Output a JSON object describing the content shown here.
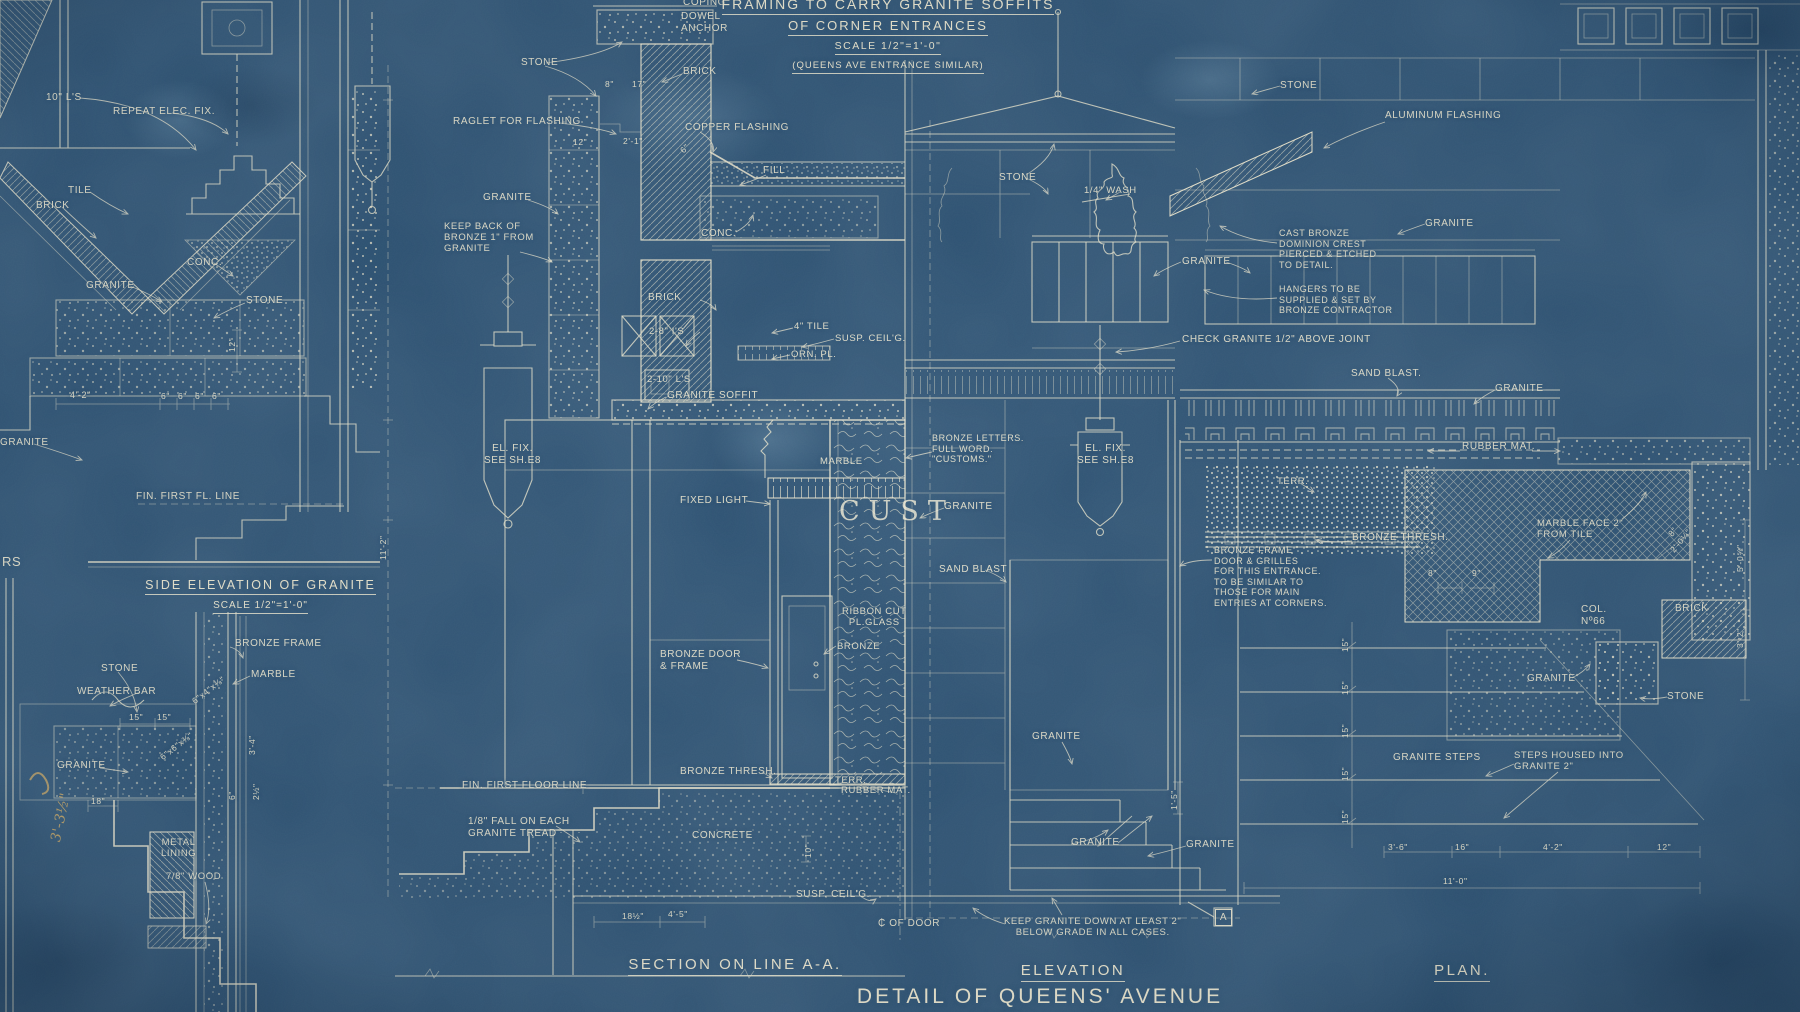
{
  "sheet": {
    "kind": "blueprint architectural drawing",
    "colors": {
      "background": "#2d5273",
      "ink": "#e9e3cb",
      "sepia_pencil": "#c6a35f"
    }
  },
  "titles": {
    "framing": {
      "line1": "FRAMING TO CARRY GRANITE SOFFITS",
      "line2": "OF CORNER ENTRANCES",
      "scale": "SCALE 1/2\"=1'-0\"",
      "note": "(QUEENS AVE ENTRANCE SIMILAR)"
    },
    "side_elevation": {
      "title": "SIDE ELEVATION OF GRANITE",
      "scale": "SCALE 1/2\"=1'-0\""
    },
    "section": {
      "title": "SECTION ON LINE A-A."
    },
    "elevation": {
      "title": "ELEVATION"
    },
    "plan": {
      "title": "PLAN."
    },
    "detail": {
      "title": "DETAIL OF QUEENS' AVENUE ENTRANCE"
    }
  },
  "labels": [
    {
      "t": "10\" L'S",
      "x": 46,
      "y": 92
    },
    {
      "t": "REPEAT ELEC. FIX.",
      "x": 113,
      "y": 106
    },
    {
      "t": "TILE",
      "x": 68,
      "y": 185
    },
    {
      "t": "BRICK",
      "x": 36,
      "y": 200
    },
    {
      "t": "CONC.",
      "x": 187,
      "y": 257
    },
    {
      "t": "GRANITE",
      "x": 86,
      "y": 280
    },
    {
      "t": "STONE",
      "x": 246,
      "y": 295
    },
    {
      "t": "GRANITE",
      "x": 0,
      "y": 437
    },
    {
      "t": "4'-2\"",
      "x": 70,
      "y": 390,
      "s": 9
    },
    {
      "t": "6\"",
      "x": 161,
      "y": 391,
      "s": 8.5
    },
    {
      "t": "6\"",
      "x": 178,
      "y": 391,
      "s": 8.5
    },
    {
      "t": "6\"",
      "x": 195,
      "y": 391,
      "s": 8.5
    },
    {
      "t": "6\"",
      "x": 212,
      "y": 391,
      "s": 8.5
    },
    {
      "t": "12\"",
      "x": 227,
      "y": 352,
      "r": -90,
      "s": 8.5
    },
    {
      "t": "FIN. FIRST FL. LINE",
      "x": 136,
      "y": 491
    },
    {
      "t": "RS",
      "x": 2,
      "y": 554,
      "s": 13
    },
    {
      "t": "BRONZE FRAME",
      "x": 235,
      "y": 638
    },
    {
      "t": "STONE",
      "x": 101,
      "y": 663
    },
    {
      "t": "MARBLE",
      "x": 251,
      "y": 669
    },
    {
      "t": "WEATHER BAR",
      "x": 77,
      "y": 686
    },
    {
      "t": "15\"",
      "x": 129,
      "y": 712,
      "s": 8.5
    },
    {
      "t": "15\"",
      "x": 157,
      "y": 712,
      "s": 8.5
    },
    {
      "t": "6\"x4\"x⅜\"",
      "x": 190,
      "y": 698,
      "r": -38,
      "s": 8.5
    },
    {
      "t": "GRANITE",
      "x": 57,
      "y": 760
    },
    {
      "t": "6\"x6\"x⅜\"",
      "x": 158,
      "y": 754,
      "r": -38,
      "s": 8.5
    },
    {
      "t": "3'-4\"",
      "x": 247,
      "y": 755,
      "r": -90,
      "s": 8.5
    },
    {
      "t": "18\"",
      "x": 91,
      "y": 796,
      "s": 8.5
    },
    {
      "t": "6\"",
      "x": 227,
      "y": 800,
      "r": -90,
      "s": 8.5
    },
    {
      "t": "2½\"",
      "x": 251,
      "y": 800,
      "r": -90,
      "s": 8.5
    },
    {
      "t": "METAL\nLINING",
      "x": 161,
      "y": 837,
      "ctr": 1,
      "s": 9.5
    },
    {
      "t": "7/8\" WOOD",
      "x": 166,
      "y": 871,
      "s": 9.5
    },
    {
      "t": "3'-3½\"",
      "x": 48,
      "y": 840,
      "r": -78,
      "c": "sepia",
      "s": 14
    },
    {
      "t": "COPING",
      "x": 683,
      "y": -3
    },
    {
      "t": "DOWEL\nANCHOR",
      "x": 681,
      "y": 11
    },
    {
      "t": "STONE",
      "x": 521,
      "y": 57
    },
    {
      "t": "BRICK",
      "x": 683,
      "y": 66
    },
    {
      "t": "8\"",
      "x": 605,
      "y": 79,
      "s": 8.5
    },
    {
      "t": "17\"",
      "x": 632,
      "y": 79,
      "s": 8.5
    },
    {
      "t": "RAGLET FOR FLASHING",
      "x": 453,
      "y": 116
    },
    {
      "t": "COPPER FLASHING",
      "x": 685,
      "y": 122
    },
    {
      "t": "12\"",
      "x": 573,
      "y": 137,
      "s": 8.5
    },
    {
      "t": "2'-1\"",
      "x": 623,
      "y": 136,
      "s": 8.5
    },
    {
      "t": "6\"",
      "x": 678,
      "y": 148,
      "r": -45,
      "s": 8.5
    },
    {
      "t": "FILL",
      "x": 763,
      "y": 165
    },
    {
      "t": "GRANITE",
      "x": 483,
      "y": 192
    },
    {
      "t": "KEEP BACK OF\nBRONZE 1\" FROM\nGRANITE",
      "x": 444,
      "y": 221,
      "s": 9.5
    },
    {
      "t": "CONC.",
      "x": 701,
      "y": 228
    },
    {
      "t": "BRICK",
      "x": 648,
      "y": 292
    },
    {
      "t": "2-8\" I'S",
      "x": 649,
      "y": 326,
      "s": 9.5
    },
    {
      "t": "4\" TILE",
      "x": 794,
      "y": 321,
      "s": 9.5
    },
    {
      "t": "SUSP. CEIL'G.",
      "x": 835,
      "y": 333,
      "s": 9.5
    },
    {
      "t": "ORN. PL.",
      "x": 791,
      "y": 349,
      "s": 9.5
    },
    {
      "t": "2-10\" L'S",
      "x": 647,
      "y": 374,
      "s": 9.5
    },
    {
      "t": "GRANITE SOFFIT",
      "x": 667,
      "y": 390
    },
    {
      "t": "EL. FIX.\nSEE SH.E8",
      "x": 484,
      "y": 443,
      "ctr": 1
    },
    {
      "t": "MARBLE",
      "x": 820,
      "y": 456,
      "s": 9.5
    },
    {
      "t": "FIXED LIGHT",
      "x": 680,
      "y": 495
    },
    {
      "t": "CUST",
      "x": 839,
      "y": 496,
      "c": "cust"
    },
    {
      "t": "RIBBON CUT\nPL.GLASS",
      "x": 842,
      "y": 606,
      "ctr": 1,
      "s": 9.5
    },
    {
      "t": "BRONZE",
      "x": 837,
      "y": 641,
      "s": 9.5
    },
    {
      "t": "BRONZE DOOR\n& FRAME",
      "x": 660,
      "y": 649
    },
    {
      "t": "11'-2\"",
      "x": 378,
      "y": 560,
      "r": -90,
      "s": 8.5
    },
    {
      "t": "FIN. FIRST FLOOR LINE",
      "x": 462,
      "y": 780
    },
    {
      "t": "BRONZE THRESH.",
      "x": 680,
      "y": 766
    },
    {
      "t": "TERR.",
      "x": 835,
      "y": 775,
      "s": 9.5
    },
    {
      "t": "RUBBER MAT.",
      "x": 841,
      "y": 785,
      "s": 9.5
    },
    {
      "t": "1/8\" FALL ON EACH\nGRANITE TREAD",
      "x": 468,
      "y": 816
    },
    {
      "t": "CONCRETE",
      "x": 692,
      "y": 830
    },
    {
      "t": "10\"",
      "x": 803,
      "y": 858,
      "r": -90,
      "s": 8.5
    },
    {
      "t": "SUSP. CEIL'G.",
      "x": 796,
      "y": 889
    },
    {
      "t": "18½\"",
      "x": 622,
      "y": 911,
      "s": 8.5
    },
    {
      "t": "4'-5\"",
      "x": 668,
      "y": 909,
      "s": 8.5
    },
    {
      "t": "₵ OF DOOR",
      "x": 878,
      "y": 918
    },
    {
      "t": "KEEP GRANITE DOWN AT LEAST 2\"\nBELOW GRADE IN ALL CASES.",
      "x": 1004,
      "y": 916,
      "ctr": 1,
      "s": 9.5
    },
    {
      "t": "STONE",
      "x": 999,
      "y": 172
    },
    {
      "t": "1/4\" WASH",
      "x": 1084,
      "y": 185,
      "s": 9.5
    },
    {
      "t": "GRANITE",
      "x": 1182,
      "y": 256
    },
    {
      "t": "CAST BRONZE\nDOMINION CREST\nPIERCED & ETCHED\nTO DETAIL.",
      "x": 1279,
      "y": 228,
      "s": 9
    },
    {
      "t": "HANGERS TO BE\nSUPPLIED & SET BY\nBRONZE CONTRACTOR",
      "x": 1279,
      "y": 284,
      "s": 9
    },
    {
      "t": "CHECK GRANITE 1/2\" ABOVE JOINT",
      "x": 1182,
      "y": 334
    },
    {
      "t": "SAND BLAST.",
      "x": 1351,
      "y": 368
    },
    {
      "t": "EL. FIX.\nSEE SH.E8",
      "x": 1077,
      "y": 443,
      "ctr": 1
    },
    {
      "t": "BRONZE LETTERS.\nFULL WORD.\n\"CUSTOMS.\"",
      "x": 932,
      "y": 433,
      "s": 9
    },
    {
      "t": "GRANITE",
      "x": 944,
      "y": 501
    },
    {
      "t": "SAND BLAST",
      "x": 939,
      "y": 564
    },
    {
      "t": "BRONZE FRAME\nDOOR & GRILLES\nFOR THIS ENTRANCE.\nTO BE SIMILAR TO\nTHOSE FOR MAIN\nENTRIES AT CORNERS.",
      "x": 1214,
      "y": 545,
      "s": 9
    },
    {
      "t": "GRANITE",
      "x": 1032,
      "y": 731
    },
    {
      "t": "GRANITE",
      "x": 1071,
      "y": 837
    },
    {
      "t": "GRANITE",
      "x": 1186,
      "y": 839
    },
    {
      "t": "1'-5\"",
      "x": 1169,
      "y": 810,
      "r": -90,
      "s": 8.5
    },
    {
      "t": "ALUMINUM FLASHING",
      "x": 1385,
      "y": 110
    },
    {
      "t": "STONE",
      "x": 1280,
      "y": 80
    },
    {
      "t": "GRANITE",
      "x": 1425,
      "y": 218
    },
    {
      "t": "GRANITE",
      "x": 1495,
      "y": 383
    },
    {
      "t": "RUBBER MAT.",
      "x": 1462,
      "y": 441
    },
    {
      "t": "TERR.",
      "x": 1277,
      "y": 476,
      "s": 9.5
    },
    {
      "t": "BRONZE THRESH.",
      "x": 1352,
      "y": 532
    },
    {
      "t": "MARBLE FACE 2\"\nFROM TILE",
      "x": 1537,
      "y": 518,
      "s": 9.5
    },
    {
      "t": "8\"",
      "x": 1428,
      "y": 568,
      "s": 8.5
    },
    {
      "t": "9\"",
      "x": 1472,
      "y": 568,
      "s": 8.5
    },
    {
      "t": "8\"",
      "x": 1666,
      "y": 532,
      "r": -50,
      "s": 8.5
    },
    {
      "t": "2'-0¼\"",
      "x": 1668,
      "y": 548,
      "r": -50,
      "s": 8.5
    },
    {
      "t": "COL.\nNº66",
      "x": 1581,
      "y": 604
    },
    {
      "t": "BRICK",
      "x": 1675,
      "y": 603
    },
    {
      "t": "STONE",
      "x": 1667,
      "y": 691
    },
    {
      "t": "GRANITE",
      "x": 1527,
      "y": 673
    },
    {
      "t": "GRANITE STEPS",
      "x": 1393,
      "y": 752
    },
    {
      "t": "STEPS HOUSED INTO\nGRANITE 2\"",
      "x": 1514,
      "y": 750,
      "s": 9.5
    },
    {
      "t": "15\"",
      "x": 1340,
      "y": 652,
      "r": -90,
      "s": 8.5
    },
    {
      "t": "15\"",
      "x": 1340,
      "y": 695,
      "r": -90,
      "s": 8.5
    },
    {
      "t": "15\"",
      "x": 1340,
      "y": 738,
      "r": -90,
      "s": 8.5
    },
    {
      "t": "15\"",
      "x": 1340,
      "y": 781,
      "r": -90,
      "s": 8.5
    },
    {
      "t": "15\"",
      "x": 1340,
      "y": 824,
      "r": -90,
      "s": 8.5
    },
    {
      "t": "3'-6\"",
      "x": 1388,
      "y": 842,
      "s": 8.5
    },
    {
      "t": "16\"",
      "x": 1455,
      "y": 842,
      "s": 8.5
    },
    {
      "t": "4'-2\"",
      "x": 1543,
      "y": 842,
      "s": 8.5
    },
    {
      "t": "12\"",
      "x": 1657,
      "y": 842,
      "s": 8.5
    },
    {
      "t": "11'-0\"",
      "x": 1443,
      "y": 876,
      "s": 8.5
    },
    {
      "t": "A",
      "x": 1215,
      "y": 909,
      "c": "mark"
    },
    {
      "t": "5'-0⅝\"",
      "x": 1735,
      "y": 572,
      "r": -90,
      "s": 8.5
    },
    {
      "t": "3'-2\"",
      "x": 1735,
      "y": 648,
      "r": -90,
      "s": 8.5
    }
  ]
}
